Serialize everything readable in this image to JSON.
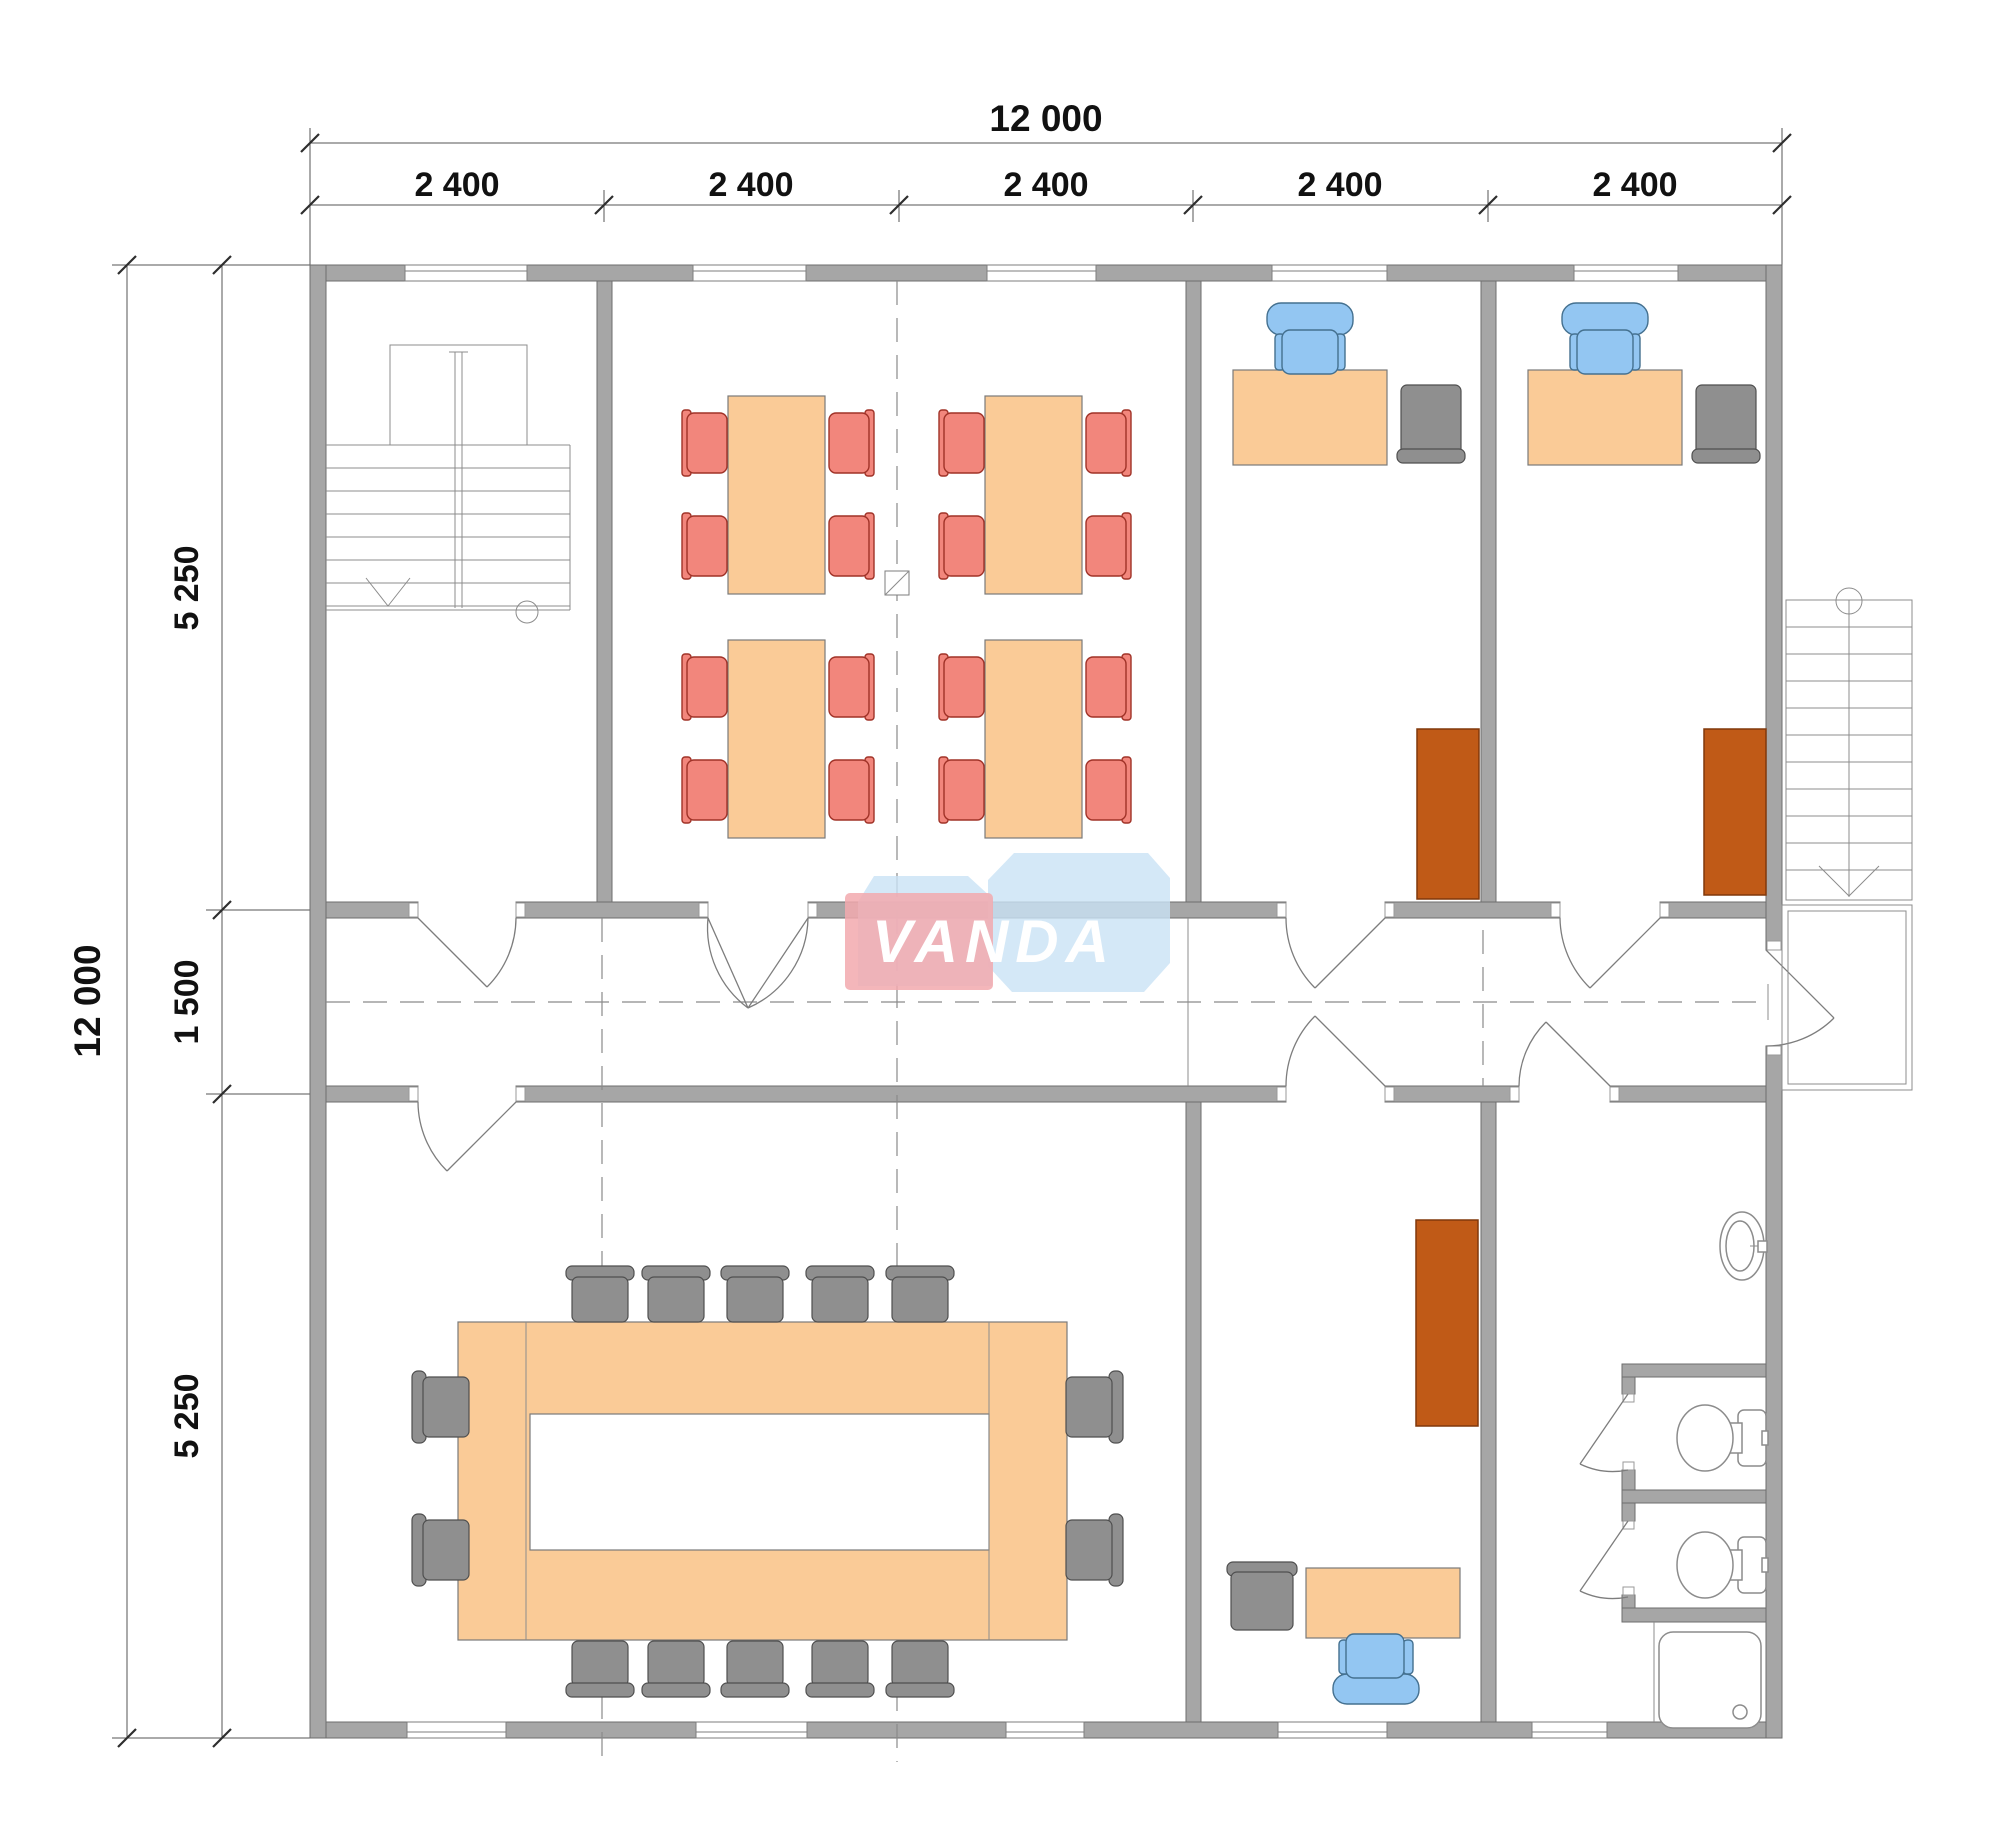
{
  "drawing": {
    "type": "architectural-floor-plan",
    "units": "mm"
  },
  "dimensions": {
    "top": {
      "total": "12 000",
      "bays": [
        "2 400",
        "2 400",
        "2 400",
        "2 400",
        "2 400"
      ]
    },
    "left": {
      "total": "12 000",
      "segments": [
        "5 250",
        "1 500",
        "5 250"
      ]
    }
  },
  "watermark": {
    "text": "VANDA"
  },
  "colors": {
    "wall": "#A6A6A6",
    "wall_edge": "#6E6E6E",
    "line": "#8C8C8C",
    "dim_line": "#555555",
    "dim_text": "#111111",
    "table": "#FACB97",
    "table_edge": "#7A7A7A",
    "chair_red": "#F2867C",
    "chair_red_edge": "#A03227",
    "chair_blue": "#93C6F2",
    "chair_blue_edge": "#44708F",
    "chair_gray": "#8F8F8F",
    "chair_gray_edge": "#4F4F4F",
    "cabinet": "#C05A17",
    "cabinet_edge": "#80380C",
    "fixture_edge": "#8C8C8C",
    "wm_blue": "#C9E2F5",
    "wm_pink": "#F2A9AE",
    "wm_text": "#FFFFFF"
  },
  "furniture": {
    "dining_tables": 4,
    "red_chairs": 16,
    "top_offices": 2,
    "office_desks": 3,
    "blue_office_chairs": 3,
    "gray_side_chairs": 3,
    "cabinets": 3,
    "conference_tables": 1,
    "conference_chairs": 14,
    "toilets": 2,
    "sinks": 1,
    "showers": 1,
    "staircases": 2
  }
}
